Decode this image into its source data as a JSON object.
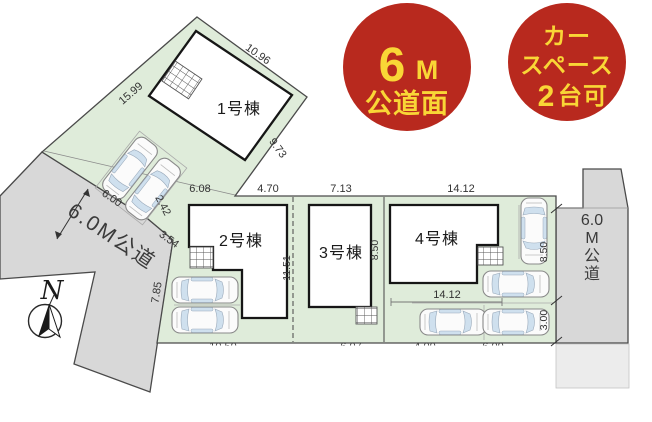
{
  "badges": {
    "road": {
      "big": "6",
      "unit": "M",
      "line2": "公道面"
    },
    "car": {
      "line1": "カー",
      "line2": "スペース",
      "num": "2",
      "suffix": "台可"
    }
  },
  "compass": {
    "north": "N"
  },
  "roads": {
    "left": {
      "label": "6.0M公道"
    },
    "right": {
      "l1": "6.0",
      "l2": "M",
      "l3": "公",
      "l4": "道"
    }
  },
  "buildings": {
    "b1": "1号棟",
    "b2": "2号棟",
    "b3": "3号棟",
    "b4": "4号棟"
  },
  "dims": {
    "lot1_top": "10.96",
    "lot1_left": "15.99",
    "lot1_right": "9.73",
    "drive_width": "6.00",
    "gap": "2.42",
    "slant": "3.54",
    "road_side": "7.85",
    "top_1": "6.08",
    "top_2": "4.70",
    "top_3": "7.13",
    "top_4": "14.12",
    "mid_depth": "11.51",
    "lot34_depth": "8.50",
    "right_upper": "8.50",
    "right_lower": "3.00",
    "lot4_bottom": "14.12",
    "cut_1": "10.50",
    "cut_2": "6.07",
    "cut_3": "4.00",
    "cut_4": "6.00"
  },
  "colors": {
    "parcel_green": "#dfecda",
    "road_gray": "#d8d8d8",
    "badge_red": "#b8291e",
    "badge_yellow": "#f9d636"
  }
}
